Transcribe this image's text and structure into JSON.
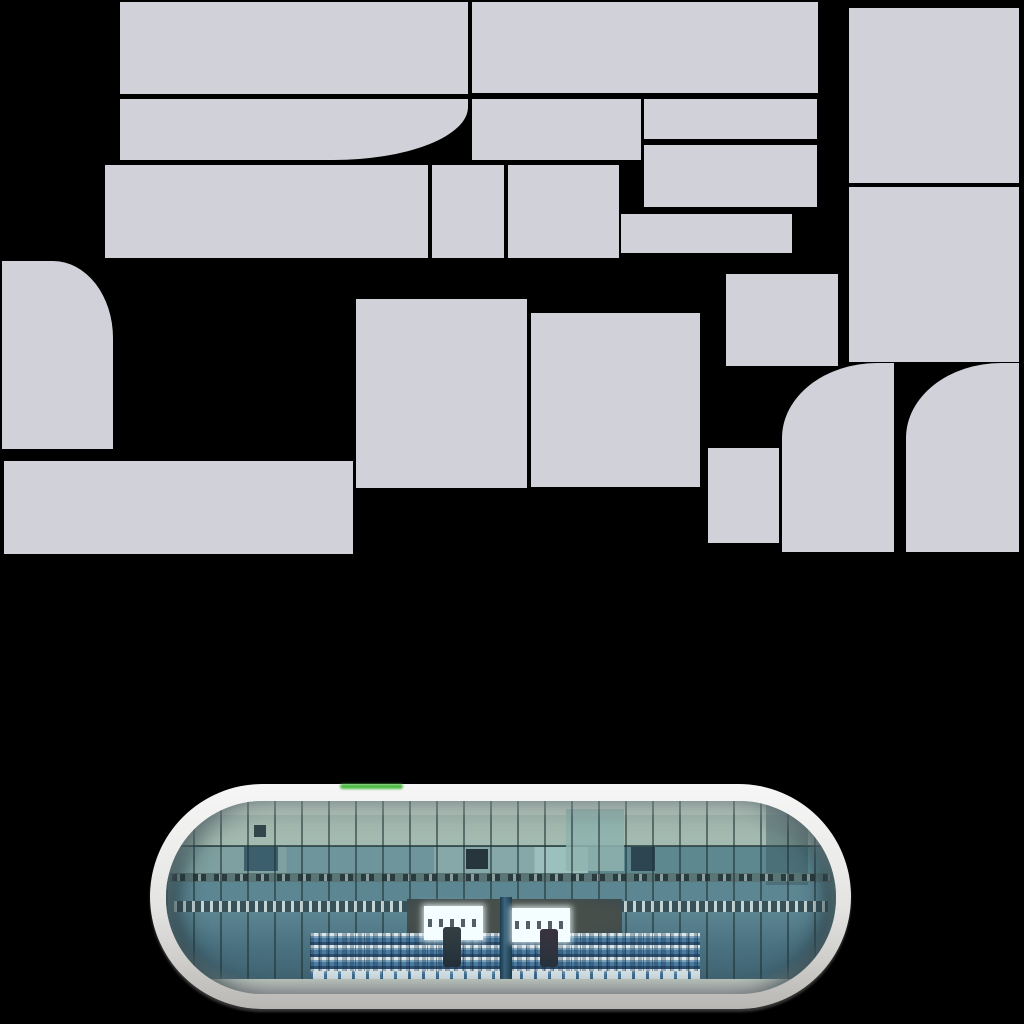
{
  "canvas": {
    "width": 1024,
    "height": 1024,
    "background": "#000000"
  },
  "atlas": {
    "description": "lavender-gray texture atlas blocks on black",
    "block_color": "#d1d1d9",
    "blocks": [
      {
        "x": 120,
        "y": 2,
        "w": 348,
        "h": 92
      },
      {
        "x": 472,
        "y": 2,
        "w": 346,
        "h": 91
      },
      {
        "x": 849,
        "y": 8,
        "w": 170,
        "h": 175
      },
      {
        "x": 120,
        "y": 99,
        "w": 348,
        "h": 61,
        "br": "135px 53px"
      },
      {
        "x": 472,
        "y": 99,
        "w": 169,
        "h": 61
      },
      {
        "x": 644,
        "y": 99,
        "w": 173,
        "h": 40
      },
      {
        "x": 644,
        "y": 145,
        "w": 173,
        "h": 62
      },
      {
        "x": 621,
        "y": 214,
        "w": 171,
        "h": 39
      },
      {
        "x": 105,
        "y": 165,
        "w": 323,
        "h": 93
      },
      {
        "x": 432,
        "y": 165,
        "w": 72,
        "h": 93
      },
      {
        "x": 508,
        "y": 165,
        "w": 111,
        "h": 93
      },
      {
        "x": 849,
        "y": 187,
        "w": 170,
        "h": 175
      },
      {
        "x": 2,
        "y": 261,
        "w": 111,
        "h": 188,
        "tr": "60px 77px"
      },
      {
        "x": 356,
        "y": 299,
        "w": 171,
        "h": 189
      },
      {
        "x": 531,
        "y": 313,
        "w": 169,
        "h": 174
      },
      {
        "x": 726,
        "y": 274,
        "w": 112,
        "h": 92
      },
      {
        "x": 708,
        "y": 448,
        "w": 71,
        "h": 95
      },
      {
        "x": 4,
        "y": 461,
        "w": 349,
        "h": 93
      },
      {
        "x": 782,
        "y": 363,
        "w": 112,
        "h": 189,
        "tl": "95px 75px"
      },
      {
        "x": 906,
        "y": 363,
        "w": 113,
        "h": 189,
        "tl": "95px 75px"
      }
    ]
  },
  "capsule": {
    "description": "pill-shaped photo texture of glass stadium facade with grandstand",
    "x": 150,
    "y": 784,
    "w": 701,
    "h": 225,
    "green_streak": {
      "x": 340,
      "y": 784,
      "w": 63,
      "h": 5,
      "color": "#4dbb44"
    },
    "colors": {
      "rim_top": "#f6f6f6",
      "rim_mid": "#e3e3e2",
      "rim_bottom": "#b9b7b3",
      "shadow": "#a8a8a8",
      "glass_pale": "#c2d3c7",
      "glass_sage": "#a3bab0",
      "glass_teal": "#6f959c",
      "glass_deep": "#49707f",
      "band_dark": "#474f4b",
      "sign_white": "#f4fdff",
      "stand_blue": "#4a7da4",
      "stand_navy": "#2e5071",
      "stand_white": "#d9e6ea",
      "floor": "#c6d0c6",
      "divider": "#39647d",
      "figure": "#23303a",
      "mullion": "#1e3032"
    }
  }
}
